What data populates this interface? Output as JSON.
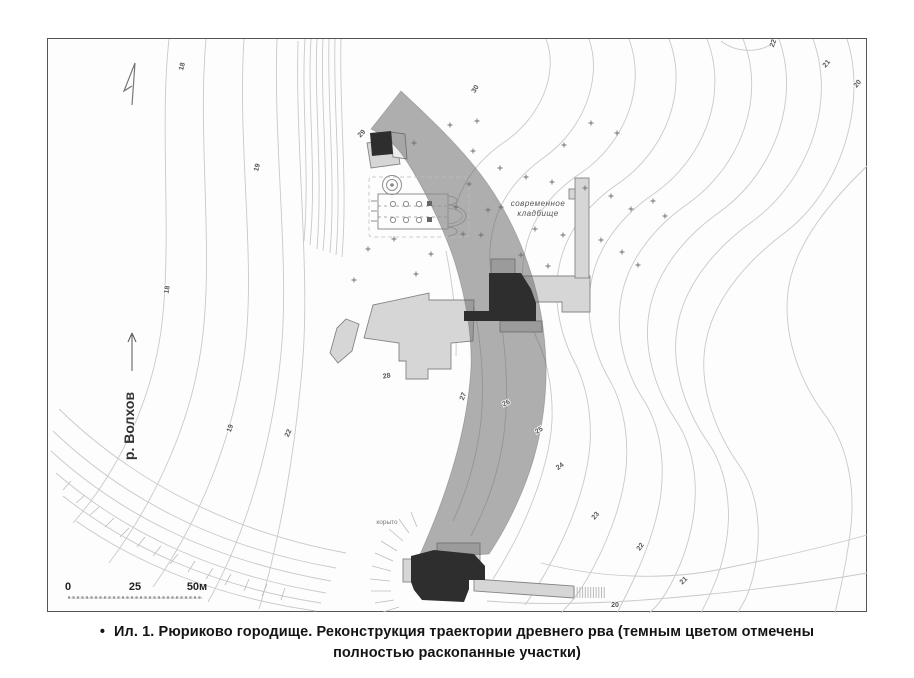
{
  "figure": {
    "caption": {
      "bullet": "•",
      "line1": "Ил. 1. Рюриково городище. Реконструкция траектории древнего рва (темным цветом отмечены",
      "line2": "полностью раскопанные участки)"
    }
  },
  "map": {
    "river": {
      "label": "р. Волхов"
    },
    "cemetery": {
      "line1": "современное",
      "line2": "кладбище"
    },
    "depression_label": "корыто",
    "scale_bar": {
      "start": "0",
      "middle": "25",
      "end": "50м"
    },
    "contour_labels": [
      "18",
      "19",
      "18",
      "19",
      "22",
      "29",
      "30",
      "22",
      "21",
      "20",
      "28",
      "27",
      "26",
      "25",
      "24",
      "23",
      "22",
      "21",
      "20"
    ],
    "colors": {
      "ditch_band": "rgba(95,95,95,0.5)",
      "excavated_dark": "#2e2e2e",
      "trench_light": "#d6d6d6",
      "contour_line": "#c9c9c9"
    }
  }
}
